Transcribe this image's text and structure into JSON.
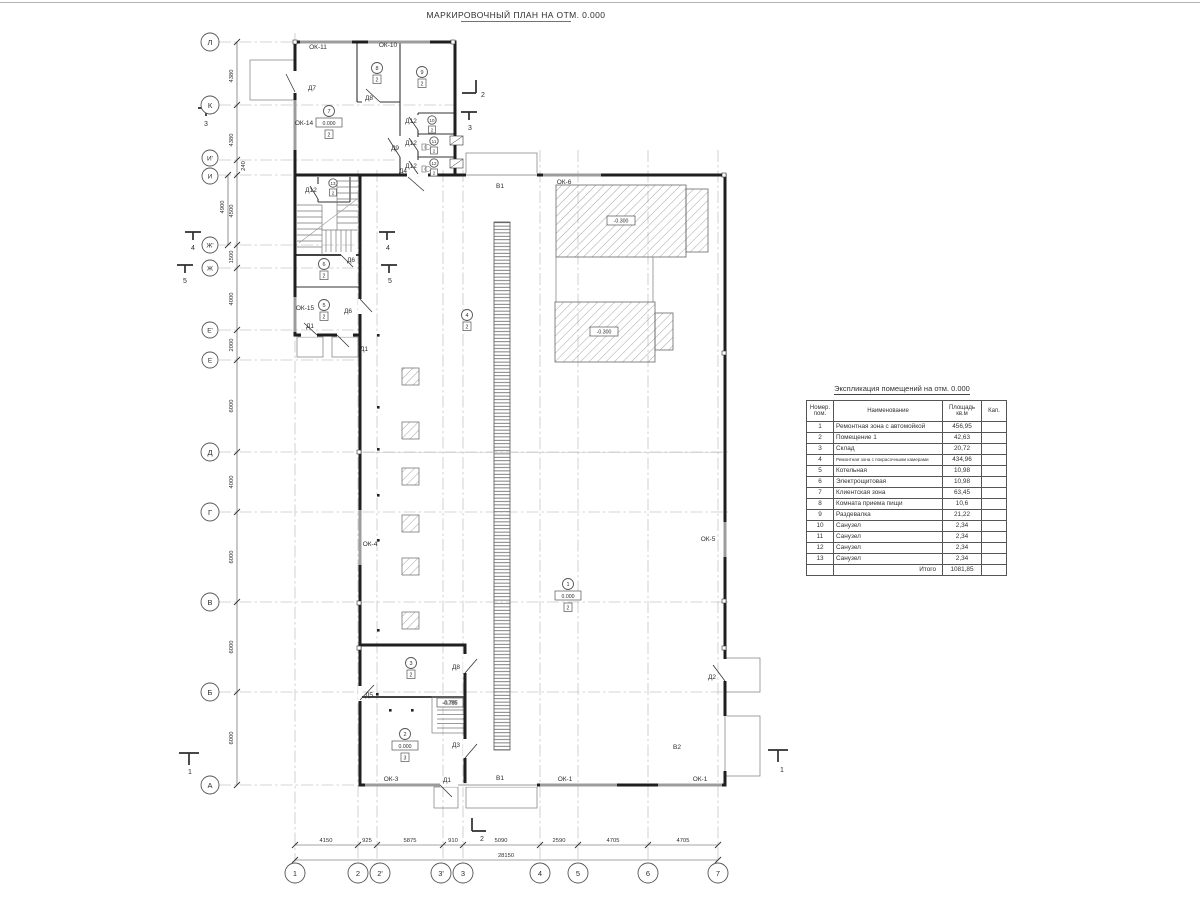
{
  "plan": {
    "title": "МАРКИРОВОЧНЫЙ ПЛАН НА ОТМ. 0.000",
    "grid_rows": [
      "Л",
      "К",
      "И'",
      "И",
      "Ж'",
      "Ж",
      "Е'",
      "Е",
      "Д",
      "Г",
      "В",
      "Б",
      "А"
    ],
    "grid_cols": [
      "1",
      "2",
      "2'",
      "3'",
      "3",
      "4",
      "5",
      "6",
      "7"
    ],
    "dims_left": [
      "4380",
      "4380",
      "240",
      "4500",
      "4900",
      "1500",
      "4000",
      "2000",
      "6000",
      "4000",
      "6000",
      "6000",
      "6000"
    ],
    "dims_bottom": [
      "4150",
      "925",
      "5875",
      "910",
      "5090",
      "2590",
      "4705",
      "4705"
    ],
    "dim_total": "28150",
    "windows": [
      "ОК-11",
      "ОК-10",
      "ОК-14",
      "ОК-15",
      "ОК-6",
      "ОК-4",
      "ОК-5",
      "ОК-3",
      "ОК-1",
      "ОК-1"
    ],
    "doors": [
      "Д7",
      "Д8",
      "Д9",
      "Д4",
      "Д12",
      "Д12",
      "Д12",
      "Д12",
      "Д6",
      "Д6",
      "Д1",
      "Д1",
      "Д5",
      "Д8",
      "Д3",
      "Д1",
      "Д2"
    ],
    "gates": [
      "В1",
      "В1",
      "В2"
    ],
    "sections": [
      "1",
      "2",
      "3",
      "4",
      "5"
    ],
    "elevations": {
      "pit1": "-0.300",
      "pit2": "-0.300",
      "stair": "-0.785"
    },
    "rooms": [
      {
        "num": "1",
        "elev": "0.000",
        "cap": "2"
      },
      {
        "num": "2",
        "elev": "0.000",
        "cap": "3"
      },
      {
        "num": "3",
        "cap": "2"
      },
      {
        "num": "4",
        "cap": "2"
      },
      {
        "num": "5",
        "cap": "2"
      },
      {
        "num": "6",
        "cap": "2"
      },
      {
        "num": "7",
        "elev": "0.000",
        "cap": "2"
      },
      {
        "num": "8",
        "cap": "2"
      },
      {
        "num": "9",
        "cap": "2"
      },
      {
        "num": "10",
        "cap": "2"
      },
      {
        "num": "11",
        "cap": "2"
      },
      {
        "num": "12",
        "cap": "2"
      },
      {
        "num": "13",
        "cap": "2"
      }
    ]
  },
  "schedule": {
    "title": "Экспликация помещений на отм. 0.000",
    "headers": {
      "num": "Номер. пом.",
      "name": "Наименование",
      "area": "Площадь кв.м",
      "cap": "Кап."
    },
    "rows": [
      {
        "n": "1",
        "name": "Ремонтная зона с автомойкой",
        "area": "456,95"
      },
      {
        "n": "2",
        "name": "Помещение 1",
        "area": "42,63"
      },
      {
        "n": "3",
        "name": "Склад",
        "area": "20,72"
      },
      {
        "n": "4",
        "name": "Ремонтная зона с покрасочными камерами",
        "area": "434,96"
      },
      {
        "n": "5",
        "name": "Котельная",
        "area": "10,98"
      },
      {
        "n": "6",
        "name": "Электрощитовая",
        "area": "10,98"
      },
      {
        "n": "7",
        "name": "Клиентская зона",
        "area": "63,45"
      },
      {
        "n": "8",
        "name": "Комната приема пищи",
        "area": "10,6"
      },
      {
        "n": "9",
        "name": "Раздевалка",
        "area": "21,22"
      },
      {
        "n": "10",
        "name": "Санузел",
        "area": "2,34"
      },
      {
        "n": "11",
        "name": "Санузел",
        "area": "2,34"
      },
      {
        "n": "12",
        "name": "Санузел",
        "area": "2,34"
      },
      {
        "n": "13",
        "name": "Санузел",
        "area": "2,34"
      }
    ],
    "total_label": "Итого",
    "total": "1081,85"
  }
}
